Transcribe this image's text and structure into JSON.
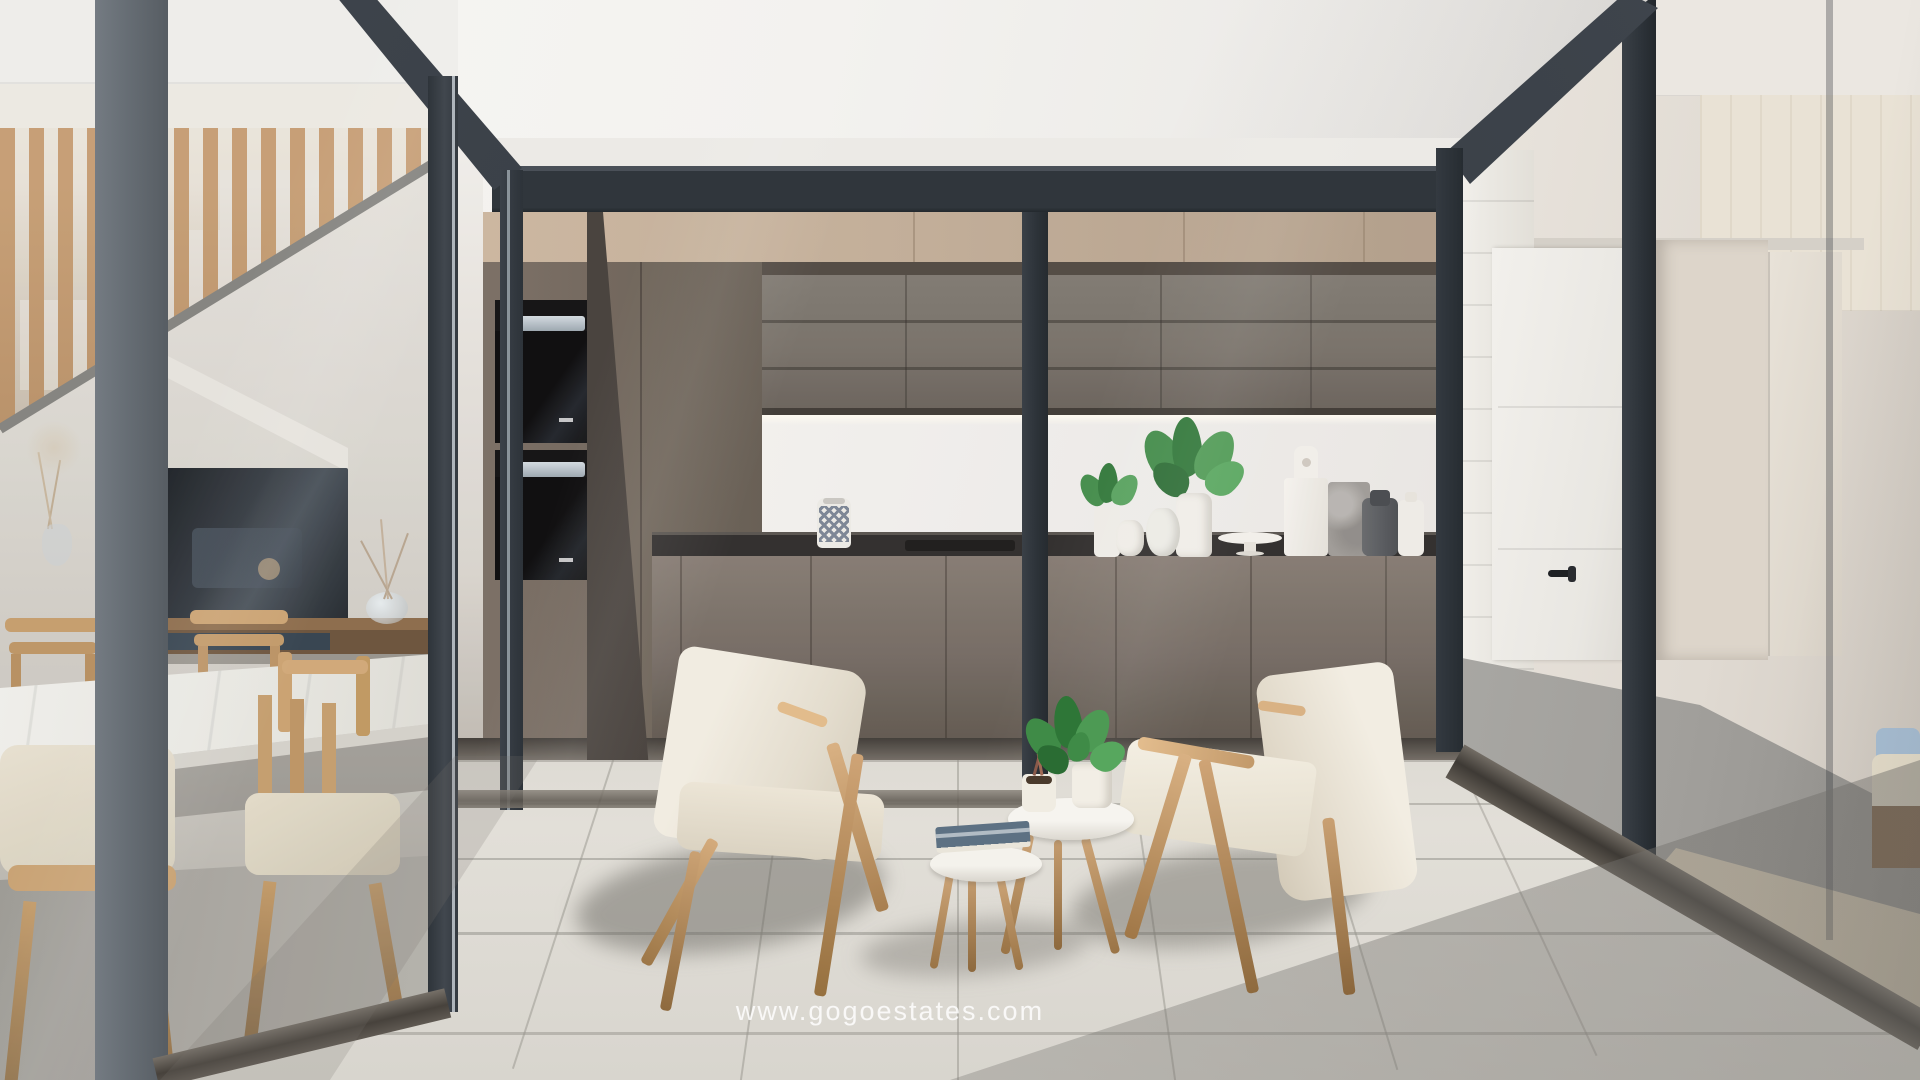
{
  "watermark": {
    "text": "www.gogoestates.com"
  },
  "palette": {
    "frame_dark": "#2f353b",
    "wall_white": "#f2f1ee",
    "upper_cabinet_beige": "#bfab95",
    "upper_cabinet_dark_gray": "#736d65",
    "backsplash_stone": "#e4dbcc",
    "countertop_black": "#2b2927",
    "base_cabinet_taupe": "#756b60",
    "courtyard_floor_tile": "#dcd9d2",
    "wood_light": "#c9a06e",
    "lounge_chair_cream": "#e9e3d6",
    "plant_green": "#3f8f48",
    "hall_floor_gray": "#a5a29e",
    "rug_beige": "#d9cdb7",
    "pillow_blue": "#a9c0d6",
    "oven_black": "#0c0c0d"
  },
  "scene": {
    "type": "architectural-interior-render",
    "setting": "glazed interior courtyard of a modern home",
    "areas": {
      "kitchen": {
        "label": "kitchen behind glass wall",
        "items": [
          "double-wall-ovens",
          "tall-cabinets",
          "patterned-vase",
          "cooktop",
          "potted-plants",
          "white-vases",
          "serving-plate",
          "white-cutting-board",
          "marble-cutting-board",
          "gray-jar",
          "white-bottle"
        ]
      },
      "dining": {
        "label": "dining and stair area behind left glass wall",
        "items": [
          "wood-slat-stair-screen",
          "staircase",
          "tv",
          "media-console",
          "dried-flower-vases",
          "marble-dining-table",
          "wooden-dining-chairs"
        ]
      },
      "hallway": {
        "label": "hallway behind right glass wall",
        "items": [
          "white-interior-door",
          "black-door-handle",
          "open-doorway",
          "wardrobe",
          "area-rug",
          "sofa-corner",
          "blue-pillow"
        ]
      },
      "courtyard": {
        "label": "courtyard patio",
        "items": [
          "lounge-chair-left",
          "lounge-chair-right",
          "round-nesting-side-tables",
          "potted-plants",
          "book",
          "tiled-floor"
        ]
      }
    }
  }
}
